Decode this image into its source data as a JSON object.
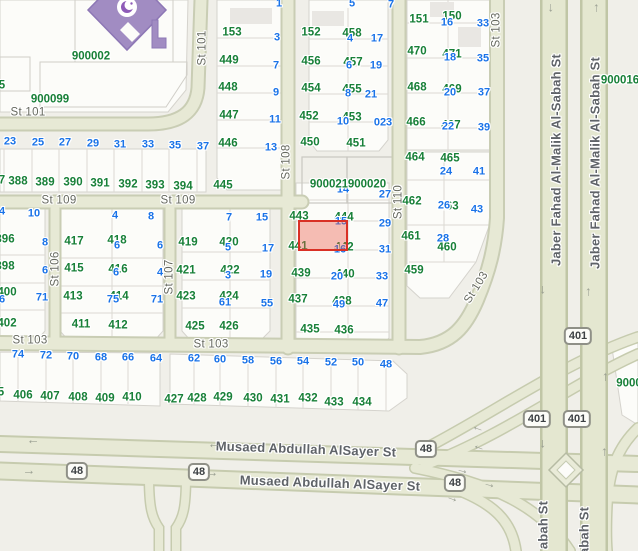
{
  "map": {
    "colors": {
      "background": "#f0efe9",
      "block_fill": "#fcfcf9",
      "road_fill": "#e7e9d5",
      "road_casing": "#c9cdb4",
      "parcel_number_green": "#188038",
      "address_number_blue": "#1a73e8",
      "street_label_gray": "#5f6368",
      "highlight_fill": "#f2a89f",
      "highlight_stroke": "#d93025",
      "mosque_purple": "#a18cc2"
    },
    "highlight_parcel": {
      "x": 298,
      "y": 220,
      "w": 50,
      "h": 31
    },
    "street_labels": [
      {
        "t": "St 101",
        "x": 28,
        "y": 113,
        "r": 0
      },
      {
        "t": "St 101",
        "x": 203,
        "y": 48,
        "r": -90
      },
      {
        "t": "St 109",
        "x": 59,
        "y": 201,
        "r": 0
      },
      {
        "t": "St 109",
        "x": 178,
        "y": 201,
        "r": 0
      },
      {
        "t": "St 106",
        "x": 56,
        "y": 269,
        "r": -90
      },
      {
        "t": "St 107",
        "x": 170,
        "y": 277,
        "r": -90
      },
      {
        "t": "St 108",
        "x": 287,
        "y": 162,
        "r": -90
      },
      {
        "t": "St 110",
        "x": 399,
        "y": 202,
        "r": -90
      },
      {
        "t": "St 103",
        "x": 30,
        "y": 341,
        "r": 0
      },
      {
        "t": "St 103",
        "x": 211,
        "y": 345,
        "r": 0
      },
      {
        "t": "St 103",
        "x": 477,
        "y": 288,
        "r": -58
      },
      {
        "t": "St 103",
        "x": 497,
        "y": 30,
        "r": -90
      },
      {
        "t": "Musaed Abdullah AlSayer St",
        "x": 306,
        "y": 449,
        "r": 2,
        "major": true
      },
      {
        "t": "Musaed Abdullah AlSayer St",
        "x": 330,
        "y": 483,
        "r": 2,
        "major": true
      },
      {
        "t": "Jaber Fahad Al-Malik Al-Sabah St",
        "x": 556,
        "y": 160,
        "r": -90,
        "major": true
      },
      {
        "t": "Jaber Fahad Al-Malik Al-Sabah St",
        "x": 595,
        "y": 163,
        "r": -90,
        "major": true
      },
      {
        "t": "abah St",
        "x": 543,
        "y": 525,
        "r": -90,
        "major": true
      },
      {
        "t": "abah St",
        "x": 584,
        "y": 531,
        "r": -90,
        "major": true
      }
    ],
    "complex_numbers": [
      {
        "t": "900002",
        "x": 91,
        "y": 57
      },
      {
        "t": "900099",
        "x": 50,
        "y": 100
      },
      {
        "t": "900016",
        "x": 620,
        "y": 81
      },
      {
        "t": "900021",
        "x": 329,
        "y": 185
      },
      {
        "t": "900020",
        "x": 367,
        "y": 185
      },
      {
        "t": "9000",
        "x": 629,
        "y": 384
      }
    ],
    "parcel_numbers": [
      {
        "t": "5",
        "x": 2,
        "y": 86
      },
      {
        "t": "7",
        "x": 2,
        "y": 181
      },
      {
        "t": "388",
        "x": 18,
        "y": 182
      },
      {
        "t": "389",
        "x": 45,
        "y": 183
      },
      {
        "t": "390",
        "x": 73,
        "y": 183
      },
      {
        "t": "391",
        "x": 100,
        "y": 184
      },
      {
        "t": "392",
        "x": 128,
        "y": 185
      },
      {
        "t": "393",
        "x": 155,
        "y": 186
      },
      {
        "t": "394",
        "x": 183,
        "y": 187
      },
      {
        "t": "153",
        "x": 232,
        "y": 33
      },
      {
        "t": "449",
        "x": 229,
        "y": 61
      },
      {
        "t": "448",
        "x": 228,
        "y": 88
      },
      {
        "t": "447",
        "x": 229,
        "y": 116
      },
      {
        "t": "446",
        "x": 228,
        "y": 144
      },
      {
        "t": "445",
        "x": 223,
        "y": 186
      },
      {
        "t": "152",
        "x": 311,
        "y": 33
      },
      {
        "t": "458",
        "x": 352,
        "y": 34
      },
      {
        "t": "456",
        "x": 311,
        "y": 62
      },
      {
        "t": "457",
        "x": 353,
        "y": 63
      },
      {
        "t": "454",
        "x": 311,
        "y": 89
      },
      {
        "t": "455",
        "x": 352,
        "y": 90
      },
      {
        "t": "452",
        "x": 309,
        "y": 117
      },
      {
        "t": "453",
        "x": 352,
        "y": 118
      },
      {
        "t": "450",
        "x": 310,
        "y": 143
      },
      {
        "t": "451",
        "x": 356,
        "y": 144
      },
      {
        "t": "151",
        "x": 419,
        "y": 20
      },
      {
        "t": "150",
        "x": 452,
        "y": 17
      },
      {
        "t": "470",
        "x": 417,
        "y": 52
      },
      {
        "t": "471",
        "x": 452,
        "y": 55
      },
      {
        "t": "468",
        "x": 417,
        "y": 88
      },
      {
        "t": "469",
        "x": 452,
        "y": 90
      },
      {
        "t": "466",
        "x": 416,
        "y": 123
      },
      {
        "t": "467",
        "x": 451,
        "y": 126
      },
      {
        "t": "464",
        "x": 415,
        "y": 158
      },
      {
        "t": "465",
        "x": 450,
        "y": 159
      },
      {
        "t": "462",
        "x": 412,
        "y": 202
      },
      {
        "t": "463",
        "x": 449,
        "y": 207
      },
      {
        "t": "461",
        "x": 411,
        "y": 237
      },
      {
        "t": "460",
        "x": 447,
        "y": 248
      },
      {
        "t": "459",
        "x": 414,
        "y": 271
      },
      {
        "t": "443",
        "x": 299,
        "y": 217
      },
      {
        "t": "444",
        "x": 344,
        "y": 218
      },
      {
        "t": "441",
        "x": 298,
        "y": 247
      },
      {
        "t": "442",
        "x": 344,
        "y": 248
      },
      {
        "t": "439",
        "x": 301,
        "y": 274
      },
      {
        "t": "440",
        "x": 345,
        "y": 275
      },
      {
        "t": "437",
        "x": 298,
        "y": 300
      },
      {
        "t": "438",
        "x": 342,
        "y": 302
      },
      {
        "t": "435",
        "x": 310,
        "y": 330
      },
      {
        "t": "436",
        "x": 344,
        "y": 331
      },
      {
        "t": "396",
        "x": 5,
        "y": 240
      },
      {
        "t": "398",
        "x": 5,
        "y": 267
      },
      {
        "t": "400",
        "x": 7,
        "y": 293
      },
      {
        "t": "402",
        "x": 7,
        "y": 324
      },
      {
        "t": "417",
        "x": 74,
        "y": 242
      },
      {
        "t": "418",
        "x": 117,
        "y": 241
      },
      {
        "t": "415",
        "x": 74,
        "y": 269
      },
      {
        "t": "416",
        "x": 118,
        "y": 270
      },
      {
        "t": "413",
        "x": 73,
        "y": 297
      },
      {
        "t": "414",
        "x": 119,
        "y": 297
      },
      {
        "t": "411",
        "x": 81,
        "y": 325
      },
      {
        "t": "412",
        "x": 118,
        "y": 326
      },
      {
        "t": "419",
        "x": 188,
        "y": 243
      },
      {
        "t": "420",
        "x": 229,
        "y": 243
      },
      {
        "t": "421",
        "x": 186,
        "y": 271
      },
      {
        "t": "422",
        "x": 230,
        "y": 271
      },
      {
        "t": "423",
        "x": 186,
        "y": 297
      },
      {
        "t": "424",
        "x": 229,
        "y": 297
      },
      {
        "t": "425",
        "x": 195,
        "y": 327
      },
      {
        "t": "426",
        "x": 229,
        "y": 327
      },
      {
        "t": "5",
        "x": 1,
        "y": 393
      },
      {
        "t": "406",
        "x": 23,
        "y": 396
      },
      {
        "t": "407",
        "x": 50,
        "y": 397
      },
      {
        "t": "408",
        "x": 78,
        "y": 398
      },
      {
        "t": "409",
        "x": 105,
        "y": 399
      },
      {
        "t": "410",
        "x": 132,
        "y": 398
      },
      {
        "t": "427",
        "x": 174,
        "y": 400
      },
      {
        "t": "428",
        "x": 197,
        "y": 399
      },
      {
        "t": "429",
        "x": 223,
        "y": 398
      },
      {
        "t": "430",
        "x": 253,
        "y": 399
      },
      {
        "t": "431",
        "x": 280,
        "y": 400
      },
      {
        "t": "432",
        "x": 308,
        "y": 399
      },
      {
        "t": "433",
        "x": 334,
        "y": 403
      },
      {
        "t": "434",
        "x": 362,
        "y": 403
      }
    ],
    "address_numbers": [
      {
        "t": "23",
        "x": 10,
        "y": 142
      },
      {
        "t": "25",
        "x": 38,
        "y": 143
      },
      {
        "t": "27",
        "x": 65,
        "y": 143
      },
      {
        "t": "29",
        "x": 93,
        "y": 144
      },
      {
        "t": "31",
        "x": 120,
        "y": 145
      },
      {
        "t": "33",
        "x": 148,
        "y": 145
      },
      {
        "t": "35",
        "x": 175,
        "y": 146
      },
      {
        "t": "37",
        "x": 203,
        "y": 147
      },
      {
        "t": "1",
        "x": 279,
        "y": 4
      },
      {
        "t": "3",
        "x": 277,
        "y": 38
      },
      {
        "t": "7",
        "x": 276,
        "y": 66
      },
      {
        "t": "9",
        "x": 276,
        "y": 93
      },
      {
        "t": "11",
        "x": 275,
        "y": 120
      },
      {
        "t": "13",
        "x": 271,
        "y": 148
      },
      {
        "t": "5",
        "x": 352,
        "y": 4
      },
      {
        "t": "7",
        "x": 391,
        "y": 5
      },
      {
        "t": "4",
        "x": 350,
        "y": 39
      },
      {
        "t": "17",
        "x": 377,
        "y": 39
      },
      {
        "t": "6",
        "x": 349,
        "y": 66
      },
      {
        "t": "19",
        "x": 376,
        "y": 66
      },
      {
        "t": "8",
        "x": 348,
        "y": 94
      },
      {
        "t": "21",
        "x": 371,
        "y": 95
      },
      {
        "t": "10",
        "x": 343,
        "y": 122
      },
      {
        "t": "023",
        "x": 383,
        "y": 123
      },
      {
        "t": "16",
        "x": 447,
        "y": 23
      },
      {
        "t": "33",
        "x": 483,
        "y": 24
      },
      {
        "t": "18",
        "x": 450,
        "y": 58
      },
      {
        "t": "35",
        "x": 483,
        "y": 59
      },
      {
        "t": "20",
        "x": 450,
        "y": 93
      },
      {
        "t": "37",
        "x": 484,
        "y": 93
      },
      {
        "t": "22",
        "x": 448,
        "y": 127
      },
      {
        "t": "39",
        "x": 484,
        "y": 128
      },
      {
        "t": "24",
        "x": 446,
        "y": 172
      },
      {
        "t": "41",
        "x": 479,
        "y": 172
      },
      {
        "t": "26",
        "x": 444,
        "y": 206
      },
      {
        "t": "43",
        "x": 477,
        "y": 210
      },
      {
        "t": "28",
        "x": 443,
        "y": 239
      },
      {
        "t": "14",
        "x": 343,
        "y": 190
      },
      {
        "t": "27",
        "x": 385,
        "y": 195
      },
      {
        "t": "15",
        "x": 341,
        "y": 222
      },
      {
        "t": "29",
        "x": 385,
        "y": 224
      },
      {
        "t": "16",
        "x": 340,
        "y": 250
      },
      {
        "t": "31",
        "x": 385,
        "y": 250
      },
      {
        "t": "20",
        "x": 337,
        "y": 277
      },
      {
        "t": "33",
        "x": 382,
        "y": 277
      },
      {
        "t": "49",
        "x": 339,
        "y": 305
      },
      {
        "t": "47",
        "x": 382,
        "y": 304
      },
      {
        "t": "4",
        "x": 2,
        "y": 212
      },
      {
        "t": "10",
        "x": 34,
        "y": 214
      },
      {
        "t": "8",
        "x": 45,
        "y": 243
      },
      {
        "t": "6",
        "x": 45,
        "y": 271
      },
      {
        "t": "71",
        "x": 42,
        "y": 298
      },
      {
        "t": "6",
        "x": 2,
        "y": 300
      },
      {
        "t": "4",
        "x": 115,
        "y": 216
      },
      {
        "t": "8",
        "x": 151,
        "y": 217
      },
      {
        "t": "6",
        "x": 117,
        "y": 246
      },
      {
        "t": "6",
        "x": 160,
        "y": 246
      },
      {
        "t": "6",
        "x": 116,
        "y": 273
      },
      {
        "t": "4",
        "x": 160,
        "y": 273
      },
      {
        "t": "75",
        "x": 113,
        "y": 300
      },
      {
        "t": "71",
        "x": 157,
        "y": 300
      },
      {
        "t": "7",
        "x": 229,
        "y": 218
      },
      {
        "t": "15",
        "x": 262,
        "y": 218
      },
      {
        "t": "5",
        "x": 228,
        "y": 248
      },
      {
        "t": "17",
        "x": 268,
        "y": 249
      },
      {
        "t": "3",
        "x": 228,
        "y": 276
      },
      {
        "t": "19",
        "x": 266,
        "y": 275
      },
      {
        "t": "61",
        "x": 225,
        "y": 303
      },
      {
        "t": "55",
        "x": 267,
        "y": 304
      },
      {
        "t": "74",
        "x": 18,
        "y": 355
      },
      {
        "t": "72",
        "x": 46,
        "y": 356
      },
      {
        "t": "70",
        "x": 73,
        "y": 357
      },
      {
        "t": "68",
        "x": 101,
        "y": 358
      },
      {
        "t": "66",
        "x": 128,
        "y": 358
      },
      {
        "t": "64",
        "x": 156,
        "y": 359
      },
      {
        "t": "62",
        "x": 194,
        "y": 359
      },
      {
        "t": "60",
        "x": 220,
        "y": 360
      },
      {
        "t": "58",
        "x": 248,
        "y": 361
      },
      {
        "t": "56",
        "x": 276,
        "y": 362
      },
      {
        "t": "54",
        "x": 303,
        "y": 362
      },
      {
        "t": "52",
        "x": 331,
        "y": 363
      },
      {
        "t": "50",
        "x": 358,
        "y": 363
      },
      {
        "t": "48",
        "x": 386,
        "y": 365
      }
    ],
    "route_shields": [
      {
        "t": "48",
        "x": 77,
        "y": 471
      },
      {
        "t": "48",
        "x": 199,
        "y": 472
      },
      {
        "t": "48",
        "x": 426,
        "y": 449
      },
      {
        "t": "48",
        "x": 455,
        "y": 483
      },
      {
        "t": "401",
        "x": 578,
        "y": 336
      },
      {
        "t": "401",
        "x": 537,
        "y": 419
      },
      {
        "t": "401",
        "x": 577,
        "y": 419
      }
    ],
    "arrows": [
      {
        "x": 553,
        "y": 8,
        "r": 90
      },
      {
        "x": 594,
        "y": 8,
        "r": -90
      },
      {
        "x": 545,
        "y": 290,
        "r": 90
      },
      {
        "x": 586,
        "y": 292,
        "r": -90
      },
      {
        "x": 545,
        "y": 444,
        "r": 90
      },
      {
        "x": 603,
        "y": 377,
        "r": -90
      },
      {
        "x": 602,
        "y": 452,
        "r": -90
      },
      {
        "x": 33,
        "y": 444,
        "r": 180
      },
      {
        "x": 214,
        "y": 448,
        "r": 180
      },
      {
        "x": 29,
        "y": 470,
        "r": 0
      },
      {
        "x": 212,
        "y": 472,
        "r": 0
      },
      {
        "x": 477,
        "y": 431,
        "r": 200
      },
      {
        "x": 478,
        "y": 450,
        "r": 200
      },
      {
        "x": 463,
        "y": 469,
        "r": 15
      },
      {
        "x": 490,
        "y": 483,
        "r": 15
      },
      {
        "x": 453,
        "y": 497,
        "r": 20
      }
    ]
  }
}
